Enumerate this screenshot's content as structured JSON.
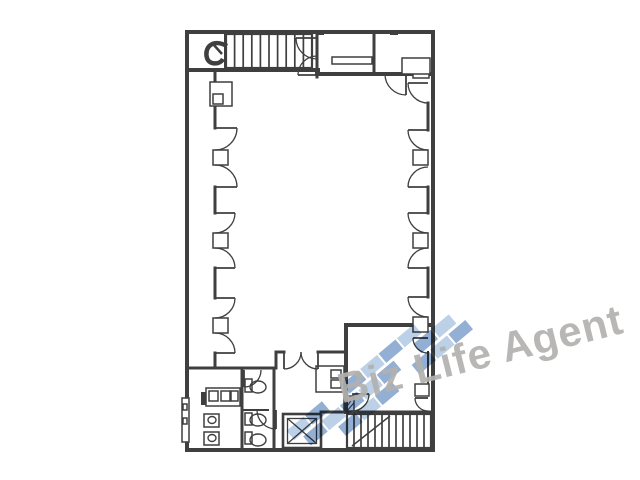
{
  "page": {
    "width": 640,
    "height": 480,
    "background": "#ffffff"
  },
  "watermark": {
    "text": "Biz Life Agent",
    "text_color": "#b2b1b0",
    "logo_palette": {
      "D": "#4a79b5",
      "L": "#8fb2d8",
      "W": "none"
    },
    "logo_tiles": [
      [
        "L",
        "D",
        "W",
        "D",
        "L",
        "D",
        "L",
        "W"
      ],
      [
        "D",
        "L",
        "D",
        "L",
        "D",
        "W",
        "D",
        "L"
      ],
      [
        "W",
        "D",
        "L",
        "D",
        "W",
        "D",
        "L",
        "D"
      ]
    ]
  },
  "floorplan": {
    "ink": "#3f3f3f",
    "label": "office-floor-plan",
    "walls": [
      [
        187,
        32,
        433,
        32,
        4,
        "outer-wall-top"
      ],
      [
        433,
        32,
        433,
        450,
        4,
        "outer-wall-right"
      ],
      [
        187,
        450,
        433,
        450,
        4,
        "outer-wall-bottom"
      ],
      [
        187,
        32,
        187,
        450,
        4,
        "outer-wall-left"
      ],
      [
        317,
        32,
        317,
        77,
        3,
        "partition-top-1"
      ],
      [
        374,
        32,
        374,
        74,
        3,
        "partition-top-2"
      ],
      [
        189,
        70,
        318,
        70,
        4,
        "stair-hall-wall"
      ],
      [
        317,
        74,
        433,
        74,
        4,
        "top-rooms-wall"
      ],
      [
        346,
        325,
        433,
        325,
        4,
        "se-room-wall-top"
      ],
      [
        346,
        325,
        346,
        412,
        4,
        "se-room-wall-left"
      ],
      [
        189,
        368,
        276,
        368,
        3,
        "restroom-wall-top"
      ],
      [
        242,
        368,
        242,
        450,
        3,
        "restroom-partition-1"
      ],
      [
        274,
        368,
        274,
        450,
        3,
        "restroom-partition-2"
      ],
      [
        242,
        410,
        268,
        410,
        2,
        "restroom-partition-3"
      ],
      [
        276,
        352,
        284,
        352,
        3,
        "vestibule-wall-left"
      ],
      [
        318,
        352,
        346,
        352,
        3,
        "vestibule-wall-right"
      ],
      [
        276,
        352,
        276,
        368,
        3,
        "vestibule-wall-side"
      ],
      [
        321,
        412,
        433,
        412,
        3,
        "stair-hall-wall-lower"
      ],
      [
        225,
        34,
        225,
        68,
        2,
        "stair-landing-divider"
      ],
      [
        215,
        70,
        215,
        82,
        3,
        "wall-left-seg-1"
      ],
      [
        215,
        106,
        215,
        128,
        3,
        "wall-left-seg-2"
      ],
      [
        215,
        187,
        215,
        213,
        3,
        "wall-left-seg-3"
      ],
      [
        215,
        268,
        215,
        298,
        3,
        "wall-left-seg-4"
      ],
      [
        215,
        353,
        215,
        368,
        3,
        "wall-left-seg-5"
      ],
      [
        428,
        103,
        428,
        130,
        3,
        "wall-right-seg-1"
      ],
      [
        428,
        187,
        428,
        213,
        3,
        "wall-right-seg-2"
      ],
      [
        428,
        268,
        428,
        297,
        3,
        "wall-right-seg-3"
      ],
      [
        428,
        352,
        428,
        384,
        2,
        "wall-right-seg-4"
      ]
    ],
    "doors": [
      {
        "h": [
          215,
          128
        ],
        "leaf": "right",
        "open": "down",
        "r": 22,
        "name": "door-left-1"
      },
      {
        "h": [
          215,
          187
        ],
        "leaf": "right",
        "open": "up",
        "r": 22,
        "name": "door-left-2"
      },
      {
        "h": [
          215,
          213
        ],
        "leaf": "right",
        "open": "down",
        "r": 20,
        "name": "door-left-3"
      },
      {
        "h": [
          215,
          268
        ],
        "leaf": "right",
        "open": "up",
        "r": 20,
        "name": "door-left-4"
      },
      {
        "h": [
          215,
          298
        ],
        "leaf": "right",
        "open": "down",
        "r": 20,
        "name": "door-left-5"
      },
      {
        "h": [
          215,
          353
        ],
        "leaf": "right",
        "open": "up",
        "r": 20,
        "name": "door-left-6"
      },
      {
        "h": [
          428,
          83
        ],
        "leaf": "left",
        "open": "down",
        "r": 20,
        "name": "door-right-1"
      },
      {
        "h": [
          428,
          130
        ],
        "leaf": "left",
        "open": "down",
        "r": 20,
        "name": "door-right-2"
      },
      {
        "h": [
          428,
          187
        ],
        "leaf": "left",
        "open": "up",
        "r": 20,
        "name": "door-right-3"
      },
      {
        "h": [
          428,
          213
        ],
        "leaf": "left",
        "open": "down",
        "r": 20,
        "name": "door-right-4"
      },
      {
        "h": [
          428,
          268
        ],
        "leaf": "left",
        "open": "up",
        "r": 20,
        "name": "door-right-5"
      },
      {
        "h": [
          428,
          297
        ],
        "leaf": "left",
        "open": "down",
        "r": 20,
        "name": "door-right-6"
      },
      {
        "h": [
          428,
          338
        ],
        "leaf": "left",
        "open": "down",
        "r": 15,
        "name": "door-se-room-1"
      },
      {
        "h": [
          428,
          398
        ],
        "leaf": "left",
        "open": "down",
        "r": 13,
        "name": "door-se-room-2"
      },
      {
        "h": [
          317,
          38
        ],
        "leaf": "left",
        "open": "down",
        "r": 21,
        "name": "door-stair-exit-1"
      },
      {
        "h": [
          317,
          75
        ],
        "leaf": "left",
        "open": "up",
        "r": 19,
        "name": "door-stair-exit-2"
      },
      {
        "h": [
          406,
          74
        ],
        "leaf": "down",
        "open": "left",
        "r": 21,
        "name": "door-top-room"
      },
      {
        "h": [
          244,
          370
        ],
        "leaf": "down",
        "open": "right",
        "r": 17,
        "name": "door-washroom"
      },
      {
        "h": [
          276,
          410
        ],
        "leaf": "down",
        "open": "left",
        "r": 19,
        "name": "door-restroom-lobby"
      },
      {
        "h": [
          352,
          394
        ],
        "leaf": "right",
        "open": "down",
        "r": 17,
        "name": "door-stair-hall"
      },
      {
        "h": [
          284,
          352
        ],
        "leaf": "down",
        "open": "right",
        "r": 17,
        "name": "double-door-left"
      },
      {
        "h": [
          318,
          352
        ],
        "leaf": "down",
        "open": "left",
        "r": 17,
        "name": "double-door-right"
      }
    ],
    "outline_rects": [
      [
        213,
        150,
        15,
        15,
        "pilaster-left-1"
      ],
      [
        213,
        233,
        15,
        15,
        "pilaster-left-2"
      ],
      [
        213,
        318,
        15,
        15,
        "pilaster-left-3"
      ],
      [
        413,
        150,
        15,
        15,
        "pilaster-right-1"
      ],
      [
        413,
        233,
        15,
        15,
        "pilaster-right-2"
      ],
      [
        413,
        317,
        15,
        15,
        "pilaster-right-3"
      ],
      [
        413,
        66,
        16,
        12,
        "pilaster-right-top"
      ],
      [
        415,
        384,
        14,
        12,
        "pilaster-se-room"
      ],
      [
        210,
        82,
        22,
        24,
        "wall-niche"
      ],
      [
        213,
        94,
        10,
        10,
        "wall-niche-inner"
      ],
      [
        332,
        57,
        40,
        7,
        "room-counter"
      ],
      [
        402,
        58,
        28,
        16,
        "room-b-niche"
      ],
      [
        316,
        366,
        28,
        26,
        "duct-enclosure"
      ],
      [
        331,
        370,
        10,
        8,
        "duct-box-1"
      ],
      [
        331,
        380,
        10,
        8,
        "duct-box-2"
      ],
      [
        206,
        388,
        34,
        18,
        "wash-counter"
      ],
      [
        209,
        391,
        9,
        10,
        "wash-basin-1"
      ],
      [
        221,
        391,
        9,
        10,
        "wash-basin-2"
      ],
      [
        231,
        391,
        7,
        10,
        "wash-basin-3"
      ],
      [
        204,
        414,
        15,
        13,
        "urinal-1"
      ],
      [
        204,
        432,
        15,
        13,
        "urinal-2"
      ],
      [
        245,
        379,
        7,
        13,
        "toilet-tank-1"
      ],
      [
        245,
        413,
        7,
        12,
        "toilet-tank-2"
      ],
      [
        245,
        432,
        7,
        12,
        "toilet-tank-3"
      ],
      [
        182,
        398,
        7,
        44,
        "exterior-shaft"
      ],
      [
        183,
        404,
        4,
        6,
        "exterior-shaft-box-1"
      ],
      [
        183,
        418,
        4,
        6,
        "exterior-shaft-box-2"
      ]
    ],
    "filled_rects": [
      [
        318,
        370,
        9,
        17,
        "duct-dark"
      ],
      [
        201,
        392,
        11,
        13,
        "wash-sink-dark"
      ],
      [
        246,
        30,
        8,
        5,
        "column-mark-top-1"
      ],
      [
        316,
        30,
        8,
        5,
        "column-mark-top-2"
      ],
      [
        390,
        30,
        8,
        5,
        "column-mark-top-3"
      ],
      [
        185,
        112,
        4,
        12,
        "column-mark-left-1"
      ],
      [
        185,
        192,
        4,
        12,
        "column-mark-left-2"
      ],
      [
        185,
        272,
        4,
        12,
        "column-mark-left-3"
      ],
      [
        431,
        112,
        4,
        12,
        "column-mark-right-1"
      ],
      [
        431,
        192,
        4,
        12,
        "column-mark-right-2"
      ],
      [
        431,
        272,
        4,
        12,
        "column-mark-right-3"
      ]
    ],
    "ellipses": [
      [
        258,
        387,
        8,
        6,
        "toilet-bowl-1"
      ],
      [
        258,
        420,
        8,
        6,
        "toilet-bowl-2"
      ],
      [
        258,
        440,
        8,
        6,
        "toilet-bowl-3"
      ],
      [
        212,
        420,
        4,
        3.5,
        "urinal-bowl-1"
      ],
      [
        212,
        438,
        4,
        3.5,
        "urinal-bowl-2"
      ]
    ],
    "stairs": [
      {
        "x": 226,
        "y": 34,
        "w": 86,
        "h": 34,
        "treads": 9,
        "name": "stairs-north"
      },
      {
        "x": 347,
        "y": 414,
        "w": 84,
        "h": 34,
        "treads": 11,
        "name": "stairs-south"
      }
    ],
    "extra_lines": [
      [
        352,
        446,
        390,
        416,
        1.5,
        "stair-break-line"
      ]
    ],
    "elevator": {
      "x": 283,
      "y": 414,
      "w": 38,
      "h": 34,
      "name": "elevator"
    },
    "hatched": [
      {
        "x": 344,
        "y": 396,
        "w": 10,
        "h": 15,
        "name": "pipe-shaft"
      }
    ],
    "stair_marker": {
      "x": 206,
      "y": 42,
      "name": "stair-direction-marker"
    }
  }
}
